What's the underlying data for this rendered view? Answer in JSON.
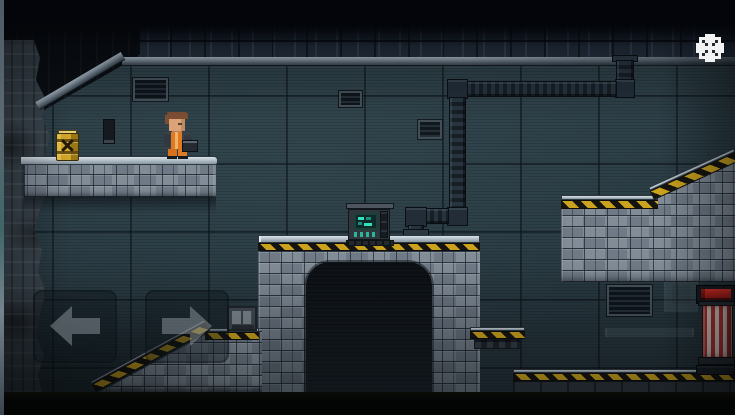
{
  "meta": {
    "app_type": "2d-pixel-platformer-game",
    "view": "industrial-prison-level"
  },
  "hud": {
    "settings_button": {
      "icon": "gear-icon"
    },
    "touch_controls": {
      "left": {
        "icon": "arrow-left-icon"
      },
      "right": {
        "icon": "arrow-right-icon"
      }
    }
  },
  "scene": {
    "player": {
      "label": "prisoner-character",
      "appearance": "orange jumpsuit, brown hair, carrying dark case",
      "facing": "right"
    },
    "props": [
      {
        "name": "hazard-barrel",
        "appearance": "yellow barrel with black X hazard mark and ribs"
      },
      {
        "name": "wall-poster",
        "appearance": "small dark wall panel"
      },
      {
        "name": "computer-terminal",
        "appearance": "gray terminal with teal pixel screen and button row"
      },
      {
        "name": "duct-pipe",
        "appearance": "dark segmented duct: ceiling flange, two elbing jogs, ends above tunnel platform"
      },
      {
        "name": "wall-vent-large",
        "appearance": "slatted vent upper-left wall"
      },
      {
        "name": "wall-vent-small-1",
        "appearance": "small slatted vent center wall"
      },
      {
        "name": "wall-vent-small-2",
        "appearance": "small slatted vent center wall lower"
      },
      {
        "name": "wall-vent-right",
        "appearance": "slatted vent below right platform"
      },
      {
        "name": "hatch-box",
        "appearance": "small metal hatch box on lower floor"
      },
      {
        "name": "striped-pylon",
        "appearance": "red and white striped pylon with red indicator cap"
      },
      {
        "name": "ghost-blocks",
        "appearance": "faint translucent blocks and rail on right wall"
      },
      {
        "name": "tunnel",
        "appearance": "dark arched passage between stone pillars"
      }
    ],
    "structures": [
      "rock-wall-left",
      "upper-left-platform",
      "tunnel-top-platform",
      "upper-right-slope-platform",
      "side-ledge",
      "bottom-left-slope-floor",
      "bottom-right-floor",
      "ceiling-brick-band",
      "metal-beam"
    ]
  },
  "colors": {
    "wall-base": "#293a42",
    "wall-light": "#2f4149",
    "stone-light": "#d9e1e6",
    "stone-mid": "#76828e",
    "hazard-yellow": "#caa21d",
    "hazard-black": "#16140e",
    "pipe-dark": "#161e26",
    "pipe-rib": "#27333e",
    "beam-light": "#808f9c",
    "barrel-yellow": "#d3a62a",
    "jumpsuit-orange": "#de7a23",
    "skin": "#dba377",
    "hair-brown": "#7c4e33",
    "screen-teal": "#35e0bd",
    "pylon-red": "#b23030",
    "pylon-white": "#d8cfc6",
    "indicator-red": "#e03028",
    "hud-white": "#f2f2f2",
    "band-black": "#03050a"
  }
}
